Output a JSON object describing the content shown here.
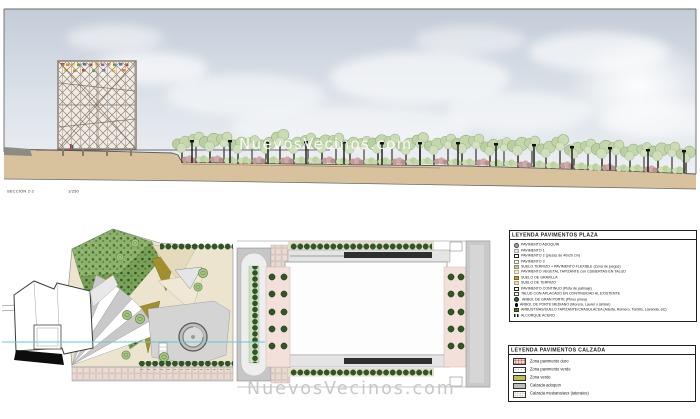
{
  "document": {
    "section_label": "SECCIÓN 2-2",
    "section_scale": "1/250"
  },
  "watermark": {
    "top": "NuevosVecinos.com",
    "bottom": "NuevosVecinos.com"
  },
  "legend_plaza": {
    "title": "LEYENDA PAVIMENTOS PLAZA",
    "items": [
      {
        "swatch": "adoquin-circle-gray",
        "label": "PAVIMENTO ADOQUÍN"
      },
      {
        "swatch": "light-gray",
        "label": "PAVIMENTO 1"
      },
      {
        "swatch": "white-outline",
        "label": "PAVIMENTO 2 (piezas de 40x20 cm)"
      },
      {
        "swatch": "white",
        "label": "PAVIMENTO 3"
      },
      {
        "swatch": "tan-stripes",
        "label": "SUELO TERRIZO + PAVIMENTO FLEXIBLE (Zona de juegos)"
      },
      {
        "swatch": "cream",
        "label": "PAVIMENTO VEGETAL TAPIZANTE con CUBIERTAS EN TALUD"
      },
      {
        "swatch": "ochre",
        "label": "SUELO DE GRAVILLA"
      },
      {
        "swatch": "pale-tan",
        "label": "SUELO DE TERRIZO"
      },
      {
        "swatch": "white-outline",
        "label": "PAVIMENTO CONTINUO (Pista de patinaje)"
      },
      {
        "swatch": "white-outline",
        "label": "TALUD CON APLACADO EN CONTINUIDAD AL EXISTENTE"
      },
      {
        "swatch": "dark-green-circle",
        "label": "ÁRBOL DE GRAN PORTE (Pinus pinea)"
      },
      {
        "swatch": "black-dot",
        "label": "ÁRBOL DE PORTE MEDIANO (Morera, Laurel o similar)"
      },
      {
        "swatch": "shrub-green",
        "label": "ARBUSTIVAS/SUELO TAPIZANTE/CRASULÁCEA (Adelfa, Romero, Tomillo, Lavanda, etc)"
      },
      {
        "swatch": "steel-squares",
        "label": "ALCORQUE ACERO"
      }
    ]
  },
  "legend_calzada": {
    "title": "LEYENDA PAVIMENTOS CALZADA",
    "items": [
      {
        "swatch": "pink-dotted",
        "label": "Zona pavimento duro"
      },
      {
        "swatch": "white-dotted",
        "label": "Zona pavimento verde"
      },
      {
        "swatch": "olive",
        "label": "Zona verde"
      },
      {
        "swatch": "gray",
        "label": "Calzada adoquín"
      },
      {
        "swatch": "fine-dotted",
        "label": "Calzada mediana/aux (laterales)"
      }
    ]
  },
  "palette": {
    "sky_top": "#c3ccd8",
    "sky_bottom": "#eef0f3",
    "ground_tan": "#d8c19d",
    "canopy_green": "#bcd1a4",
    "bush_pink": "#c29c9c",
    "park_leaf_green": "#84ab64",
    "olive_triangle": "#a08f2c",
    "tan_wedge": "#e6dabc",
    "path_gray": "#c9c9c9",
    "tree_dot_green": "#2d5826",
    "section_line_cyan": "#62c8d4",
    "watermark_gray": "#c7c7c7",
    "paver_pink": "#ead9d2"
  }
}
